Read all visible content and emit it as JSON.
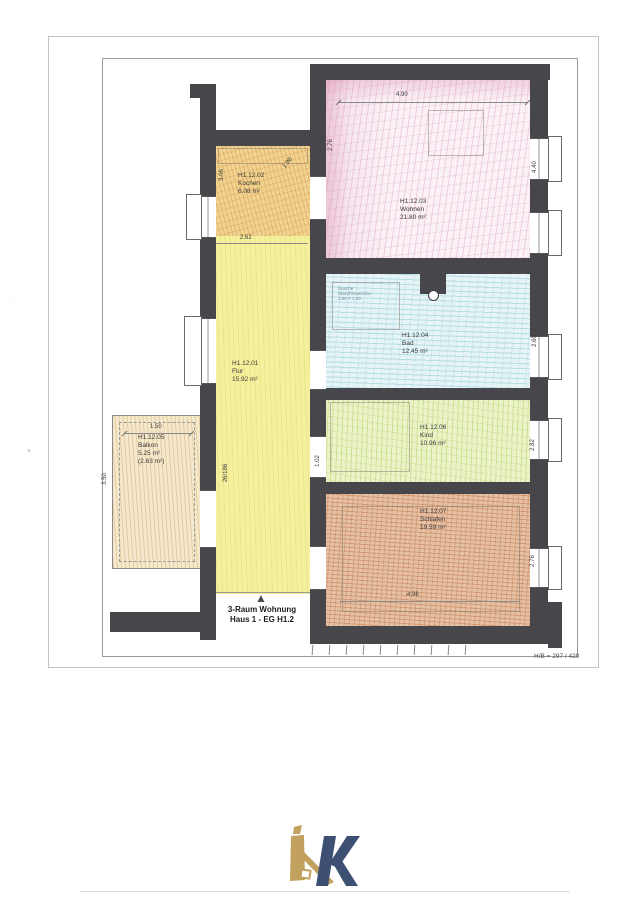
{
  "sheet": {
    "format_note": "H/B = 297 / 420"
  },
  "title": {
    "line1": "3-Raum Wohnung",
    "line2": "Haus 1 - EG H1.2"
  },
  "rooms": {
    "flur": {
      "id": "H1.12.01",
      "name": "Flur",
      "area": "15.92 m²"
    },
    "kochen": {
      "id": "H1.12.02",
      "name": "Kochen",
      "area": "6.08 m²"
    },
    "wohnen": {
      "id": "H1.12.03",
      "name": "Wohnen",
      "area": "21.80 m²"
    },
    "bad": {
      "id": "H1.12.04",
      "name": "Bad",
      "area": "12.45 m²"
    },
    "balkon": {
      "id": "H1.12.05",
      "name": "Balkon",
      "area": "5.25 m²",
      "area_counted": "(2.63 m²)"
    },
    "kind": {
      "id": "H1.12.06",
      "name": "Kind",
      "area": "10.96 m²"
    },
    "schlafen": {
      "id": "H1.12.07",
      "name": "Schlafen",
      "area": "19.59 m²"
    }
  },
  "dimensions": {
    "wohnen_top": "4.90",
    "wohnen_left": "2.76",
    "wohnen_right": "4.40",
    "bad_right": "2.60",
    "kind_right": "2.82",
    "kind_bottom": "1.02",
    "schlafen_right": "2.76",
    "schlafen_bottom": "4.96",
    "kochen_bottom": "2.62",
    "kochen_left": "3.06",
    "kochen_corner": "1.98",
    "balkon_top": "1.50",
    "balkon_left": "3.50",
    "flur_door": "26/186"
  },
  "bad_note": {
    "line1": "Dusche",
    "line2": "Waschmaschine",
    "line3": "1.08 × 1.20"
  },
  "icons": {
    "entrance_arrow": "▲",
    "logo": "k-house-logo"
  },
  "colors": {
    "wall": "#47474b",
    "wohnen_tint": "#faf2f6",
    "kochen_tint": "#f1d492",
    "flur_tint": "#f5f09e",
    "bad_tint": "#e6f4f6",
    "kind_tint": "#ecf3c8",
    "schlafen_tint": "#e5c2a5",
    "balkon_tint": "#f4e8cd",
    "logo_gold": "#c2a05e",
    "logo_navy": "#3d4f72"
  }
}
